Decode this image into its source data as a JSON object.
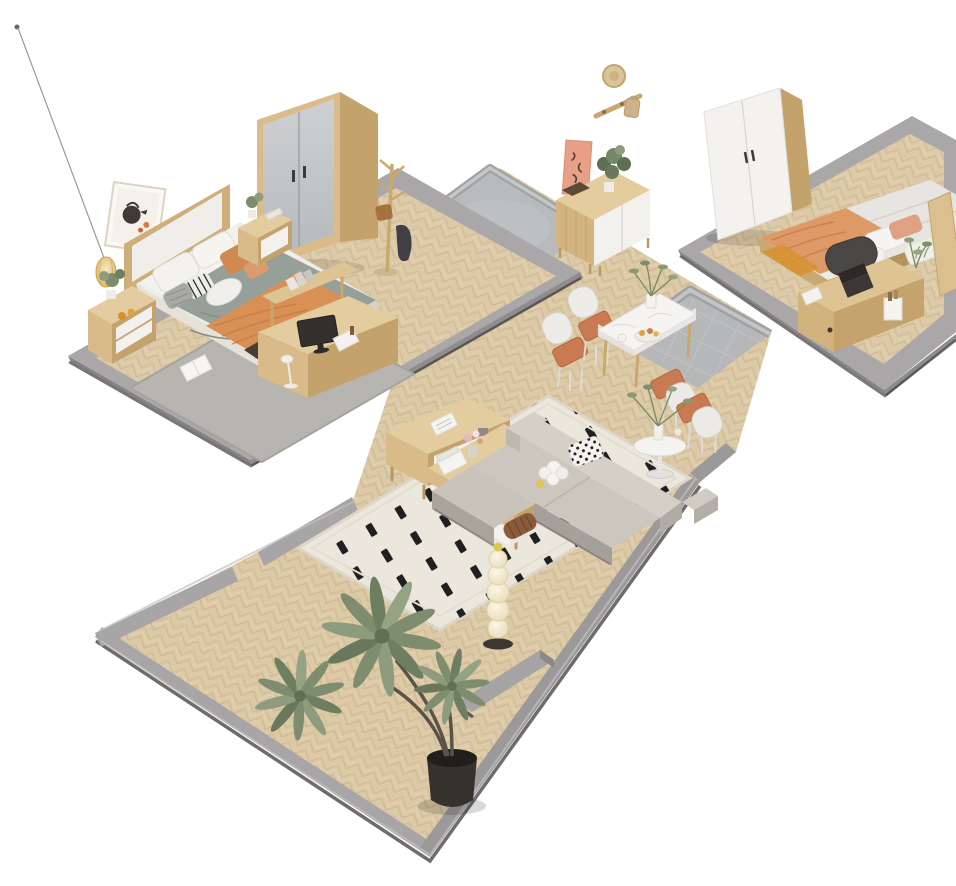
{
  "canvas": {
    "width": 956,
    "height": 886,
    "background": "#ffffff"
  },
  "scene": {
    "type": "isometric-3d-apartment-cutaway-render",
    "rooms": [
      {
        "name": "bedroom-1",
        "furniture": [
          "floor-plinth",
          "herringbone-floor",
          "gray-rug",
          "double-bed",
          "upholstered-headboard",
          "sage-duvet",
          "orange-throw-blanket",
          "pillows",
          "foot-bench",
          "nightstand-left",
          "nightstand-right",
          "sliding-door-wardrobe",
          "coat-rack",
          "pendant-lamp",
          "leaning-wall-art",
          "desk-with-monitor",
          "desk-shelf",
          "magazine-on-rug"
        ]
      },
      {
        "name": "hallway",
        "furniture": [
          "concrete-platform",
          "sideboard",
          "art-panel",
          "plant-on-sideboard",
          "hanging-wall-rack"
        ]
      },
      {
        "name": "bedroom-2",
        "furniture": [
          "floor-plinth",
          "two-door-wardrobe",
          "double-bed",
          "peach-blanket",
          "quilted-duvet",
          "pillows",
          "headboard-panel",
          "desk",
          "laptop",
          "office-chair",
          "bedside-plant"
        ]
      },
      {
        "name": "dining-area",
        "furniture": [
          "tile-platform",
          "marble-dining-table",
          "dining-chairs-4",
          "centerpiece-plant",
          "fruit-bowl",
          "round-side-table",
          "vase-plant"
        ]
      },
      {
        "name": "living-room",
        "furniture": [
          "patterned-cream-rug",
          "tv-stand",
          "coffee-table",
          "corner-sofa",
          "throw-pillows",
          "bead-floor-lamp",
          "interior-wall-stub",
          "large-potted-plant"
        ]
      }
    ]
  },
  "palette": {
    "background": "#ffffff",
    "floorWood": "#dcc9a6",
    "plinthGray": "#a9a7a8",
    "wallGray": "#a7a5a6",
    "concrete": "#b8bbbd",
    "tile": "#b5b7b9",
    "rugGray": "#b7b5b0",
    "rugCream": "#ece7dc",
    "sofaGray": "#cbc6be",
    "duvetSage": "#97a098",
    "blanketOrange": "#d89055",
    "blanketPeach": "#dd9a66",
    "terracotta": "#c97a52",
    "marble": "#f5f4f2",
    "woodLight": "#d9bc8a",
    "white": "#f3f2ef",
    "plantGreen": "#7d8d6d",
    "black": "#222222",
    "pinkArt": "#e8a087",
    "amber": "#e4b75e"
  }
}
